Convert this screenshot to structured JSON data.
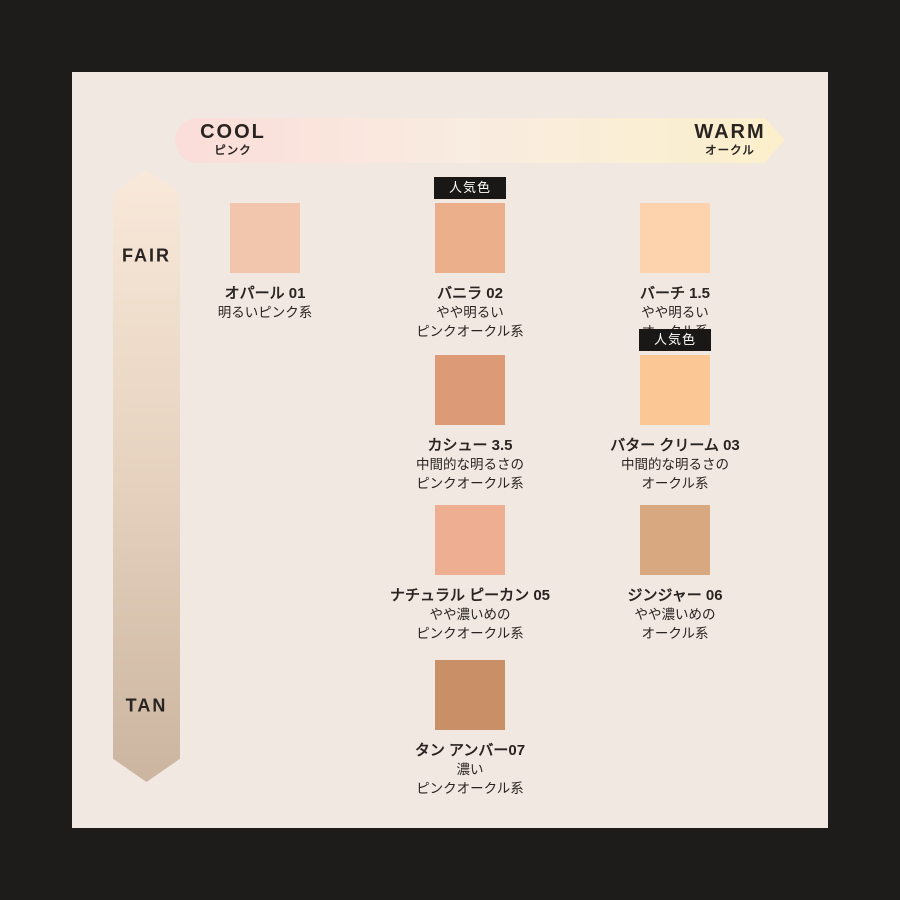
{
  "page": {
    "background": "#1d1c1a",
    "panel_background": "#f1e8e2",
    "text_color": "#292421"
  },
  "axes": {
    "horizontal": {
      "left_label": "COOL",
      "left_sublabel": "ピンク",
      "right_label": "WARM",
      "right_sublabel": "オークル",
      "gradient": [
        "#fbddd9",
        "#f9ece0",
        "#fbefcc"
      ]
    },
    "vertical": {
      "top_label": "FAIR",
      "bottom_label": "TAN",
      "gradient": [
        "#f9e9da",
        "#e6d2bf",
        "#cbb5a0"
      ]
    }
  },
  "popular_badge_label": "人気色",
  "shades": [
    {
      "name": "オパール 01",
      "desc1": "明るいピンク系",
      "desc2": "",
      "color": "#f2c6ac",
      "popular": false
    },
    {
      "name": "バニラ 02",
      "desc1": "やや明るい",
      "desc2": "ピンクオークル系",
      "color": "#ebb08b",
      "popular": true
    },
    {
      "name": "バーチ 1.5",
      "desc1": "やや明るい",
      "desc2": "オークル系",
      "color": "#fdd3ae",
      "popular": false
    },
    {
      "name": "カシュー 3.5",
      "desc1": "中間的な明るさの",
      "desc2": "ピンクオークル系",
      "color": "#dc9b76",
      "popular": false
    },
    {
      "name": "バター クリーム 03",
      "desc1": "中間的な明るさの",
      "desc2": "オークル系",
      "color": "#fbc794",
      "popular": true
    },
    {
      "name": "ナチュラル ピーカン 05",
      "desc1": "やや濃いめの",
      "desc2": "ピンクオークル系",
      "color": "#eeae92",
      "popular": false
    },
    {
      "name": "ジンジャー 06",
      "desc1": "やや濃いめの",
      "desc2": "オークル系",
      "color": "#d8a981",
      "popular": false
    },
    {
      "name": "タン アンバー07",
      "desc1": "濃い",
      "desc2": "ピンクオークル系",
      "color": "#c98f66",
      "popular": false
    }
  ]
}
